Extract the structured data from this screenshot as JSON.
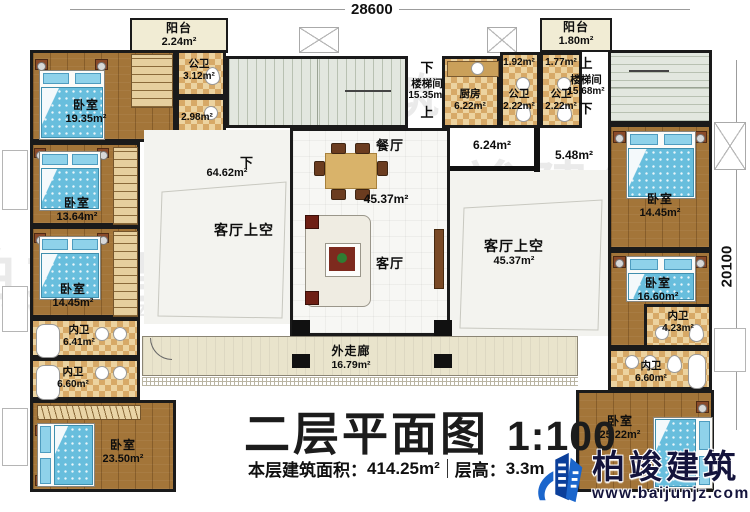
{
  "dimensions": {
    "top": "28600",
    "right": "20100"
  },
  "nav": {
    "up": "上",
    "down": "下"
  },
  "rooms": {
    "balcony_tl": {
      "name": "阳台",
      "area": "2.24m²"
    },
    "bedroom_l1": {
      "name": "卧室",
      "area": "19.35m²"
    },
    "bath_tl": {
      "name": "公卫",
      "area": "3.12m²"
    },
    "bath_tl2": {
      "area": "2.98m²"
    },
    "stair_left": {
      "name": "楼梯间",
      "area": "15.35m²"
    },
    "kitchen": {
      "name": "厨房",
      "area": "6.22m²"
    },
    "bath_c1": {
      "front_area": "1.92m²",
      "name": "公卫",
      "area": "2.22m²"
    },
    "bath_c2": {
      "front_area": "1.77m²",
      "name": "公卫",
      "area": "2.22m²"
    },
    "balcony_tr": {
      "name": "阳台",
      "area": "1.80m²"
    },
    "stair_right": {
      "name": "楼梯间",
      "area": "15.68m²"
    },
    "dining": {
      "name": "餐厅"
    },
    "living": {
      "name": "客厅",
      "area": "45.37m²"
    },
    "hall_left": {
      "area": "6.24m²"
    },
    "hall_right": {
      "area": "5.48m²"
    },
    "void_left": {
      "name": "客厅上空",
      "area": "64.62m²"
    },
    "void_right": {
      "name": "客厅上空",
      "area": "45.37m²"
    },
    "bedroom_l2": {
      "name": "卧室",
      "area": "13.64m²"
    },
    "bedroom_l3": {
      "name": "卧室",
      "area": "14.45m²"
    },
    "bath_l1": {
      "name": "内卫",
      "area": "6.41m²"
    },
    "bath_l2": {
      "name": "内卫",
      "area": "6.60m²"
    },
    "bedroom_l4": {
      "name": "卧室",
      "area": "23.50m²"
    },
    "bedroom_r1": {
      "name": "卧室",
      "area": "14.45m²"
    },
    "bedroom_r2": {
      "name": "卧室",
      "area": "16.60m²"
    },
    "bath_r1": {
      "name": "内卫",
      "area": "4.23m²"
    },
    "bath_r2": {
      "name": "内卫",
      "area": "6.60m²"
    },
    "bedroom_r3": {
      "name": "卧室",
      "area": "25.22m²"
    },
    "corridor": {
      "name": "外走廊",
      "area": "16.79m²"
    }
  },
  "title": {
    "main": "二层平面图",
    "scale": "1:100"
  },
  "stats": {
    "area_label": "本层建筑面积：",
    "area_value": "414.25m²",
    "height_label": "层高：",
    "height_value": "3.3m"
  },
  "branding": {
    "company": "柏竣建筑",
    "website": "www.baijunjz.com"
  },
  "colors": {
    "wall": "#1a1a1a",
    "wood_floor": "#a37539",
    "bed_blue": "#68bedd",
    "logo_navy": "#14143c",
    "logo_blue": "#1b66cc"
  }
}
